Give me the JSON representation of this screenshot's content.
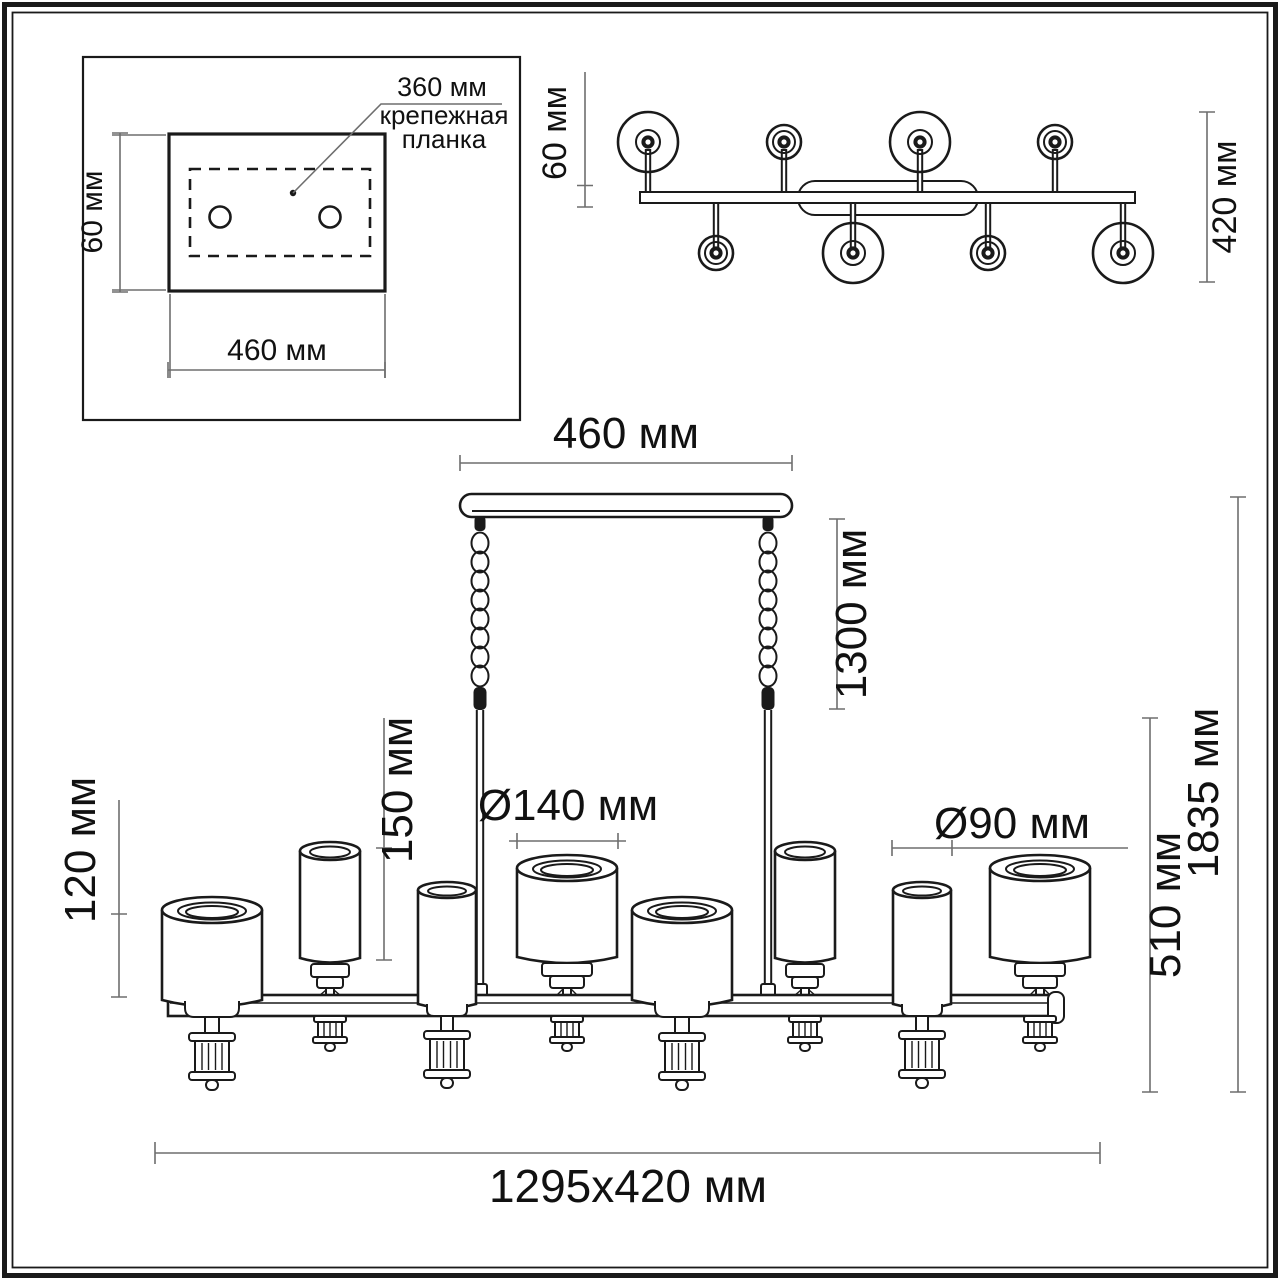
{
  "colors": {
    "line": "#1a1a1a",
    "dim": "#6e6e6e",
    "text": "#111111",
    "background": "#ffffff"
  },
  "inset": {
    "bracket_width": "360 мм",
    "bracket_name_line1": "крепежная",
    "bracket_name_line2": "планка",
    "plate_height": "60 мм",
    "plate_width": "460 мм"
  },
  "top_view": {
    "arm_offset": "60 мм",
    "fixture_depth": "420 мм"
  },
  "side_view": {
    "canopy_width": "460 мм",
    "chain_length": "1300 мм",
    "small_shade_height": "150 мм",
    "large_shade_height": "120 мм",
    "large_shade_diameter": "Ø140 мм",
    "small_shade_diameter": "Ø90 мм",
    "body_height": "510 мм",
    "total_height": "1835 мм",
    "overall_size": "1295x420 мм"
  }
}
